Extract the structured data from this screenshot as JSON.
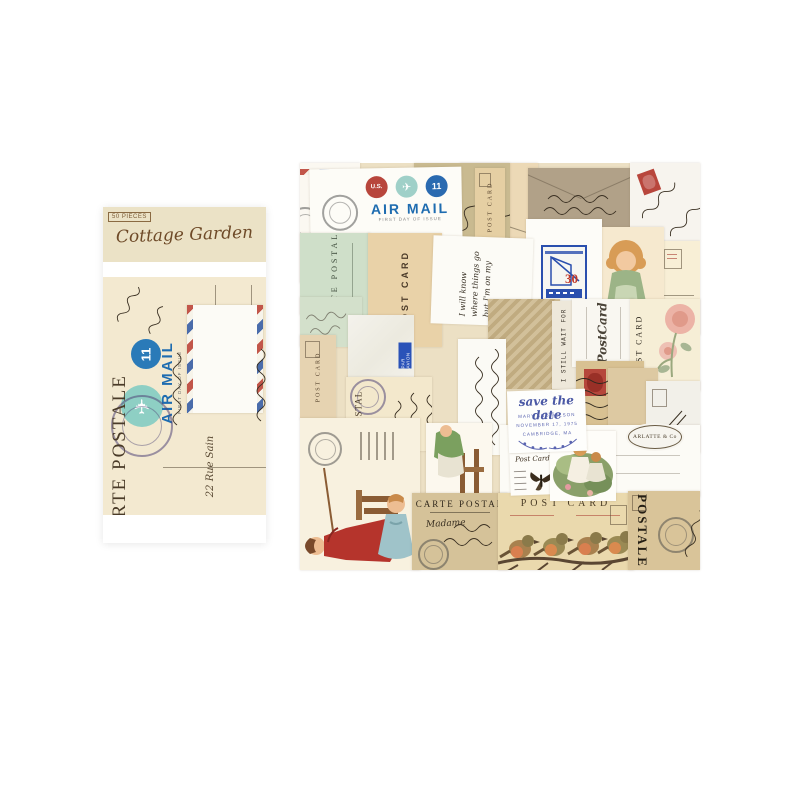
{
  "colors": {
    "background": "#ffffff",
    "package_header": "#ebe2c6",
    "cream_paper": "#f3e9d0",
    "airmail_blue": "#1e6cb0",
    "stamp_red": "#b8463c",
    "mint_green": "#cfdfc9",
    "kraft_brown": "#b1a188",
    "sepia_tan": "#d5c299",
    "postmark_purple": "#5a4a8a",
    "title_brown": "#6e4a28",
    "save_date_blue": "#4a58a5"
  },
  "package": {
    "badge": "50 PIECES",
    "title": "Cottage Garden",
    "art": {
      "air_mail": "AIR MAIL",
      "first_day": "FIRST DAY OF ISSUE",
      "eleven": "11",
      "carte_postale": "CARTE POSTALE",
      "address": "22 Rue Sain"
    }
  },
  "collage": {
    "airmail": {
      "title": "AIR MAIL",
      "subtitle": "FIRST DAY OF ISSUE",
      "us": "U.S.",
      "eleven": "11"
    },
    "labels": {
      "post_card": "POST CARD",
      "carte_postale": "CARTE POSTALE",
      "carte_postal": "CARTE POSTAL",
      "postale": "POSTALE",
      "postcard_script": "PostCard",
      "post_card_small": "Post Card",
      "par_avion": "PAR AVION",
      "still_wait": "I STILL WAIT FOR",
      "arlatte": "ARLATTE & Co",
      "thirty": "30",
      "madame": "Madame"
    },
    "note": "I will know where things go but I'm on my way.",
    "save_the_date": {
      "title": "save the date",
      "names": "MARY AND WILSON",
      "date": "NOVEMBER 17, 1975",
      "place": "CAMBRIDGE, MA"
    }
  }
}
